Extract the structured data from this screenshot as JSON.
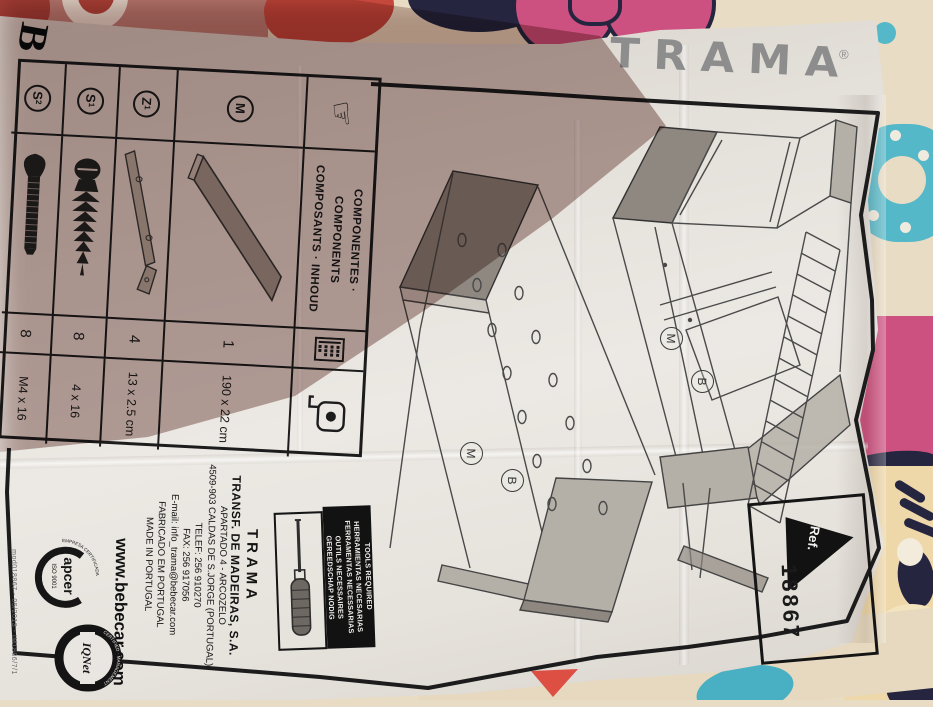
{
  "brand": {
    "logo_text": "TRAMA",
    "registered": "®",
    "corner_mark": "B"
  },
  "components_table": {
    "title_line1": "COMPONENTES · COMPONENTS",
    "title_line2": "COMPOSANTS · INHOUD",
    "hand_icon": "☞",
    "rows": [
      {
        "label": "M",
        "sub": "",
        "qty": "1",
        "size": "190 x 22 cm"
      },
      {
        "label": "Z",
        "sub": "1",
        "qty": "4",
        "size": "13 x 2.5 cm"
      },
      {
        "label": "S",
        "sub": "1",
        "qty": "8",
        "size": "4 x 16"
      },
      {
        "label": "S",
        "sub": "2",
        "qty": "8",
        "size": "M4 x 16"
      }
    ]
  },
  "diagram_labels": {
    "m": "M",
    "b": "B"
  },
  "ref_box": {
    "label": "Ref.",
    "number": "18867"
  },
  "tools_box": {
    "line1": "TOOLS REQUIRED",
    "line2": "HERRAMIENTAS NECESARIAS",
    "line3": "FERRAMENTAS NECESSARIAS",
    "line4": "OUTILS NECESSAIRES",
    "line5": "GEREEDSCHAP NODIG"
  },
  "manufacturer": {
    "name": "TRAMA",
    "company": "TRANSF. DE MADEIRAS, S.A.",
    "address1": "APARTADO 4 - ARCOZELO",
    "address2": "4509-903 CALDAS DE S.JORGE (PORTUGAL)",
    "phone": "TELEF: 256 910270",
    "fax": "FAX: 256 917056",
    "email": "E-mail: info_trama@bebecar.com",
    "made1": "FABRICADO EM PORTUGAL",
    "made2": "MADE IN PORTUGAL",
    "website": "www.bebecar.com"
  },
  "certifications": {
    "apcer_name": "apcer",
    "apcer_iso": "ISO 9001",
    "apcer_rim": "EMPRESA CERTIFICADA",
    "iqnet_name": "IQNet",
    "iqnet_rim": "CERTIFIED · MANAGEMENT SYSTEM"
  },
  "edge_note": "mod018867 - 05/2013 - IM1886/7/1",
  "colors": {
    "paper": "#ece9e4",
    "ink": "#1c1c1c",
    "pencil": "#4a4a4a",
    "logogray": "#8d8d8d",
    "shadow": "#7c514b",
    "cream": "#e8dcc4",
    "pink": "#cd5180",
    "navy": "#252540",
    "teal": "#55b8c8",
    "red": "#c5483c",
    "face": "#eed7a8",
    "redmark": "#dd4f43",
    "woodgray": "#a39c92",
    "wooddark": "#8e8880"
  }
}
